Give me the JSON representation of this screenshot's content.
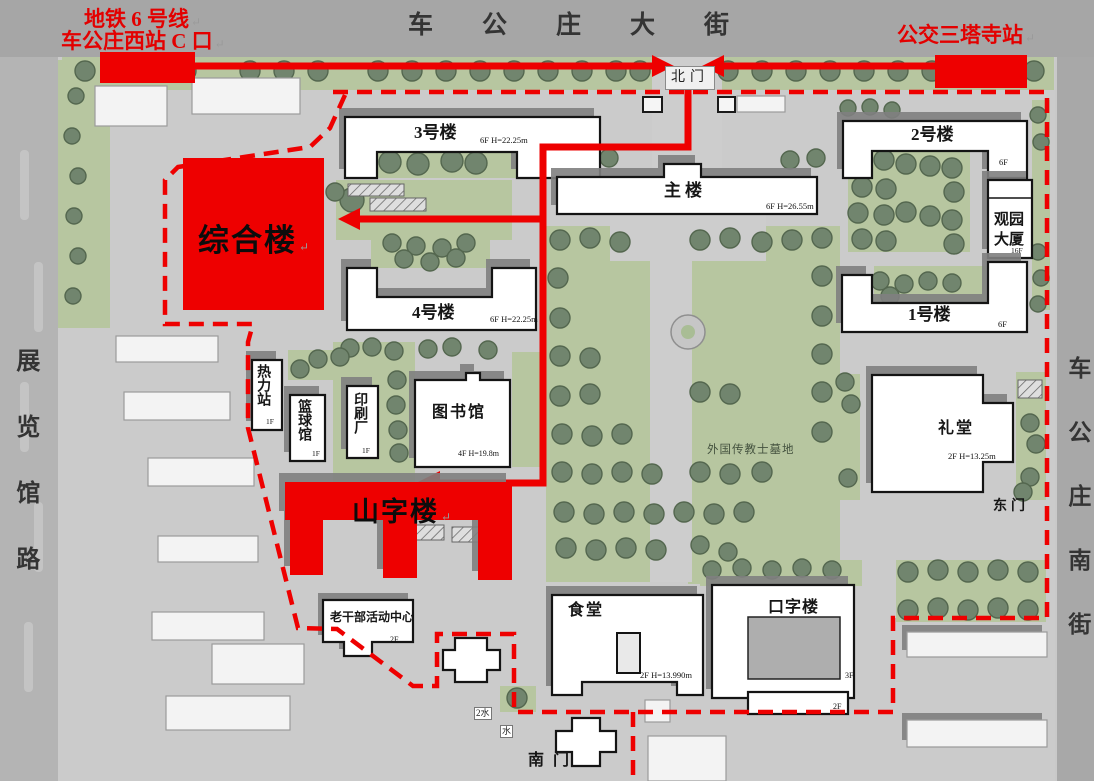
{
  "streets": {
    "top": "车公庄大街",
    "left": "展览馆路",
    "right": "车公庄南街"
  },
  "gates": {
    "north": "北门",
    "south": "南门",
    "east": "东门"
  },
  "route": {
    "metro_line1": "地铁 6 号线",
    "metro_line2": "车公庄西站 C 口",
    "bus_stop": "公交三塔寺站",
    "return_mark": "↵",
    "highlight_color": "#ee0000"
  },
  "highlights": {
    "zonghelou": "综合楼",
    "shanzilou": "山字楼"
  },
  "buildings": {
    "b3": {
      "name": "3号楼",
      "floors": "6F H=22.25m"
    },
    "b4": {
      "name": "4号楼",
      "floors": "6F H=22.25m"
    },
    "main": {
      "name": "主楼",
      "floors": "6F H=26.55m"
    },
    "b2": {
      "name": "2号楼",
      "floors": "6F"
    },
    "guanyuan": {
      "name": "观园大厦",
      "floors": "16F"
    },
    "b1": {
      "name": "1号楼",
      "floors": "6F"
    },
    "heating": {
      "name": "热力站",
      "floors": "1F"
    },
    "basketball": {
      "name": "篮球馆",
      "floors": "1F"
    },
    "printing": {
      "name": "印刷厂",
      "floors": "1F"
    },
    "library": {
      "name": "图书馆",
      "floors": "4F H=19.8m"
    },
    "auditorium": {
      "name": "礼堂",
      "floors": "2F H=13.25m"
    },
    "canteen": {
      "name": "食堂",
      "floors": "2F H=13.990m"
    },
    "kouzi": {
      "name": "口字楼",
      "floors": "3F"
    },
    "kouzi_annex": {
      "floors": "2F"
    },
    "veteran": {
      "name": "老干部活动中心",
      "floors": "2F"
    }
  },
  "labels": {
    "cemetery": "外国传教士墓地",
    "water_a": "2水",
    "water_b": "水"
  }
}
